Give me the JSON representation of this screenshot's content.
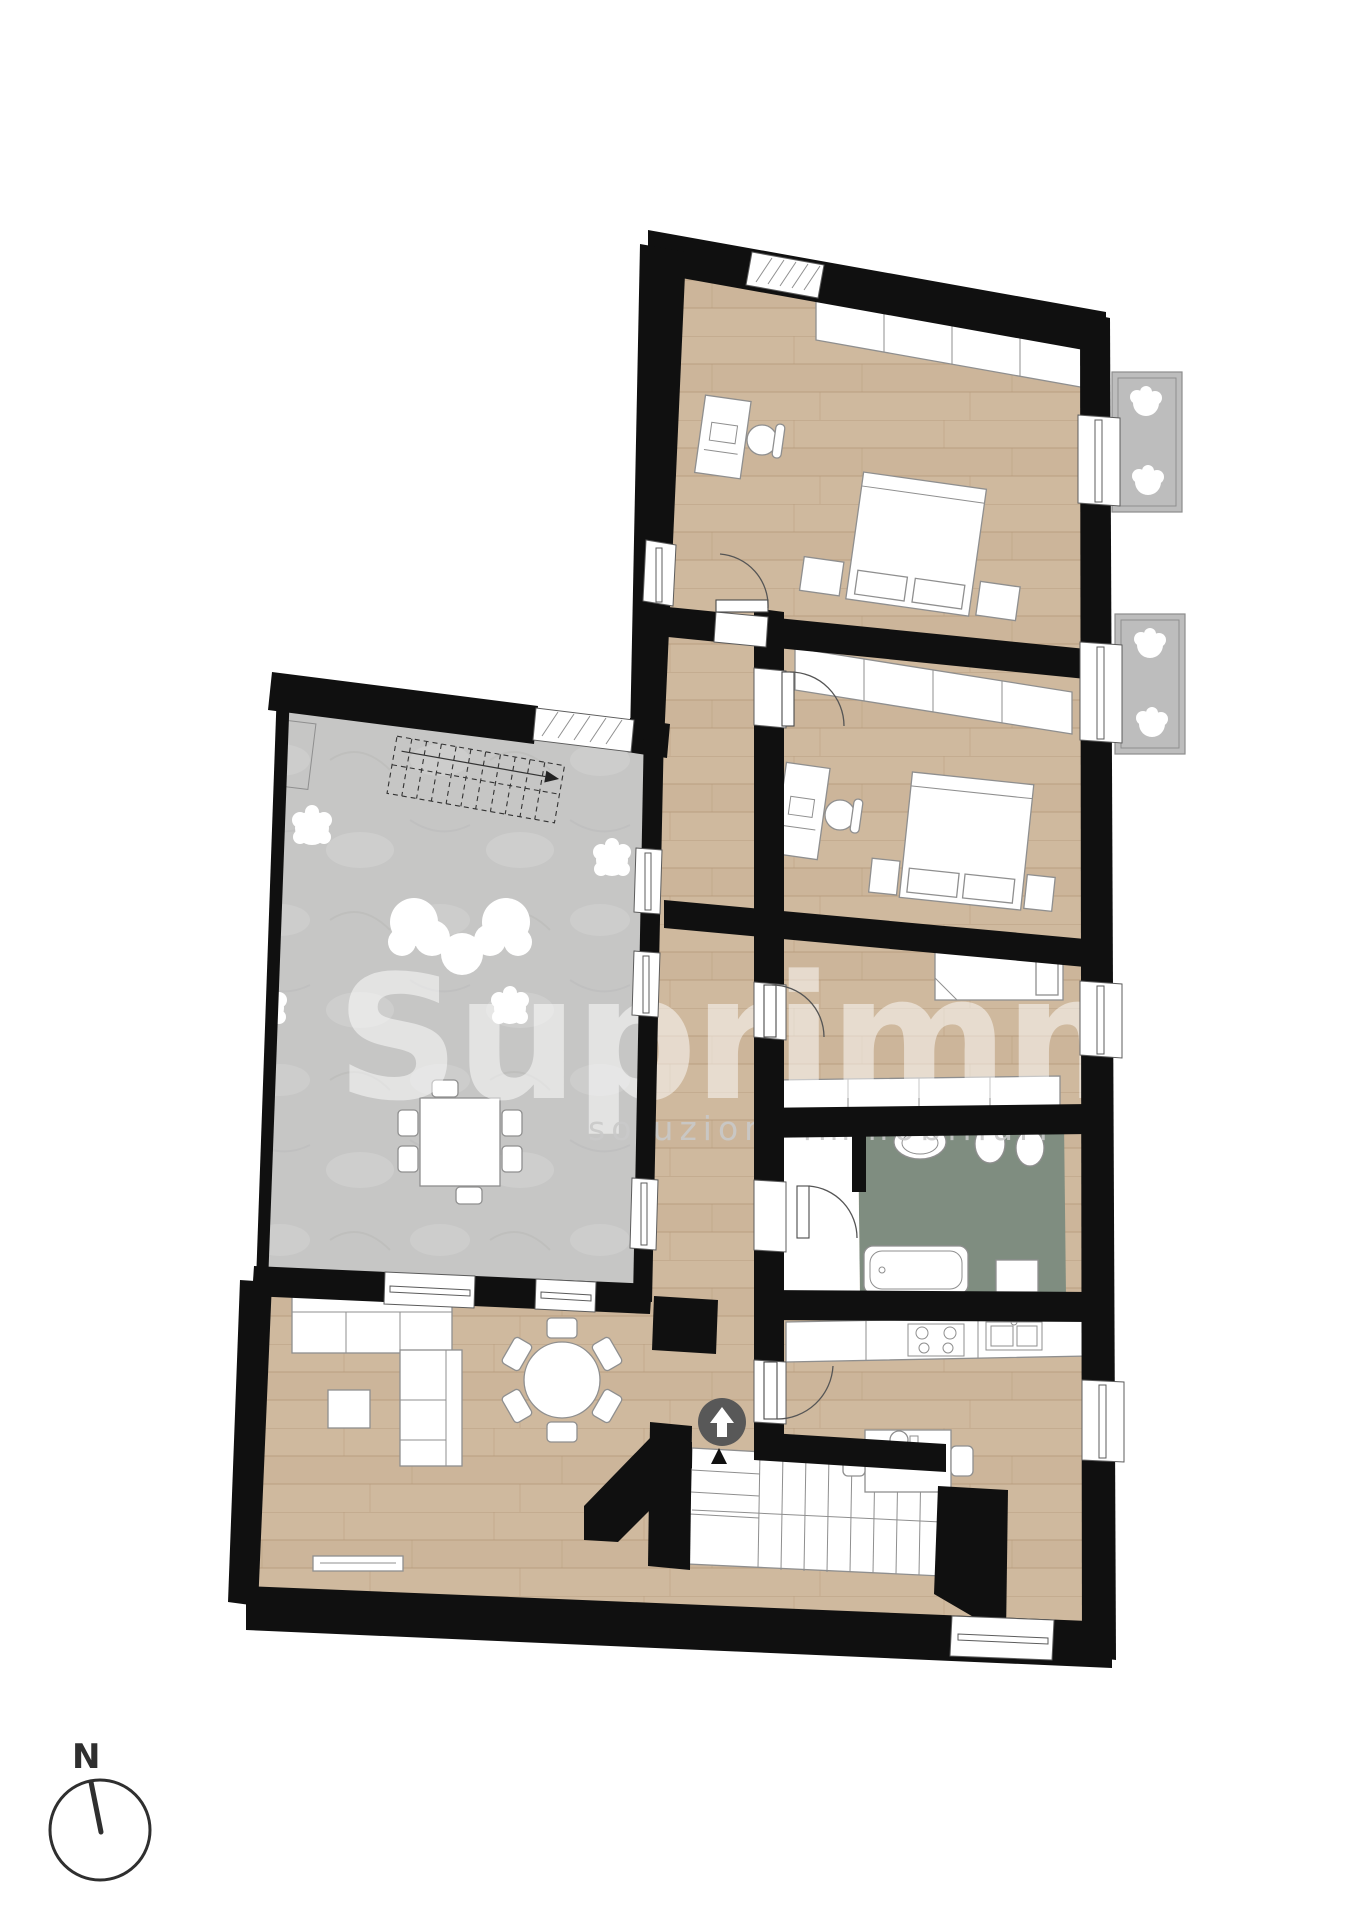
{
  "watermark": {
    "title": "Suprimm",
    "subtitle": "soluzioni immobiliari"
  },
  "compass": {
    "label": "N"
  },
  "colors": {
    "paper": "#ffffff",
    "wall": "#101010",
    "wood": "#cfb99e",
    "wood-line": "#b49878",
    "terrace": "#c6c6c5",
    "bath": "#7f8d80",
    "balcony": "#bdbdbd",
    "outline": "#8f8f8f",
    "door": "#555555",
    "badge": "#585858",
    "watermark": "#ffffff",
    "compass-ink": "#2f2f2f"
  }
}
